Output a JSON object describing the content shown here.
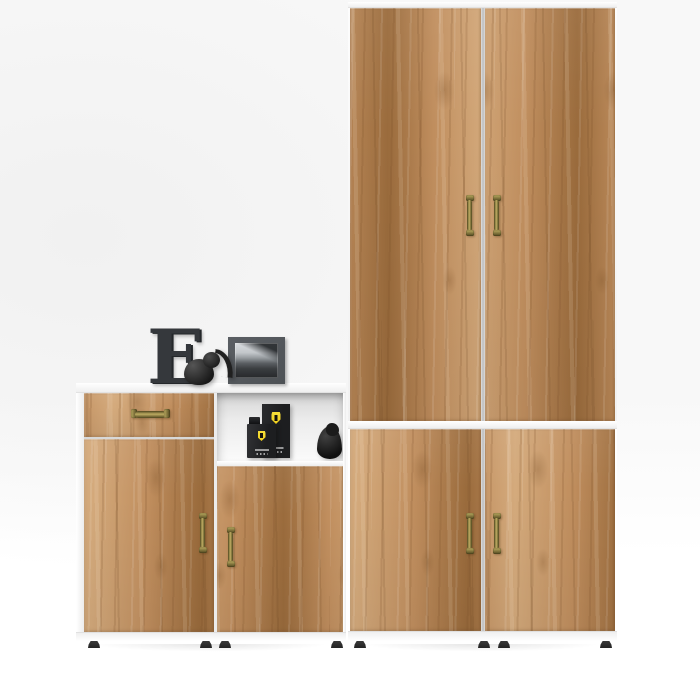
{
  "palette": {
    "bg_top": "#f8f8f8",
    "bg_bottom": "#ffffff",
    "wood_light": "#d4aa7c",
    "wood_mid": "#c08e5e",
    "wood_dark": "#9a6b3c",
    "frame_shade": "#efefef",
    "gap_line": "#bdbdbd",
    "niche_back": "#ececec",
    "brass_dark": "#4e451e",
    "brass_light": "#bcab61",
    "charcoal": "#35383c",
    "photo_frame_gray": "#4e5256",
    "black_item": "#1d1e20",
    "logo_yellow": "#f1d01c",
    "foot_black": "#232323"
  },
  "furniture": {
    "left_sideboard": {
      "name": "Low sideboard with drawer, two doors and open shelf",
      "drawer_count": 1,
      "door_count": 2,
      "handle_style": "antique brass"
    },
    "tall_wardrobe": {
      "name": "Tall two-door wardrobe",
      "door_count": 2,
      "handle_style": "antique brass"
    },
    "low_cabinet": {
      "name": "Low two-door cabinet",
      "door_count": 2,
      "handle_style": "antique brass"
    }
  },
  "decor": {
    "letter_text": "E",
    "elephant": "black elephant figurine",
    "photo": "black and white landscape photo in grey frame",
    "shelf_items": [
      "black fragrance box with yellow shield emblem",
      "black fragrance bottle with yellow shield emblem",
      "black bird figurine"
    ]
  }
}
